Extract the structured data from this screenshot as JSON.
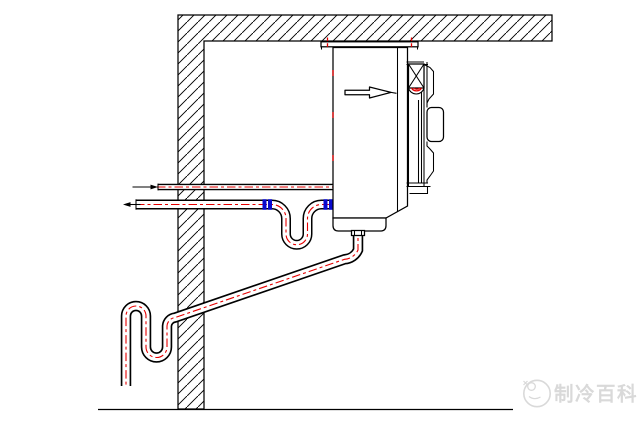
{
  "diagram": {
    "kind": "technical-drawing",
    "parts": {
      "structure": [
        "ceiling",
        "wall",
        "ground-line"
      ],
      "unit": [
        "air-cooler-body",
        "mounting-rail",
        "fan-assembly",
        "drain-pan",
        "airflow-arrow"
      ],
      "piping": [
        "liquid-line",
        "suction-line",
        "suction-u-trap",
        "pipe-couplings",
        "drain-line",
        "drain-s-trap"
      ]
    }
  },
  "watermark": {
    "logo_icon": "snowflake-badge-icon",
    "text": "制冷百科"
  },
  "colors": {
    "background": "#ffffff",
    "line": "#000000",
    "centerline": "#e60000",
    "coupling_blue": "#0a0acd",
    "watermark_gray": "#d9d9d9"
  }
}
